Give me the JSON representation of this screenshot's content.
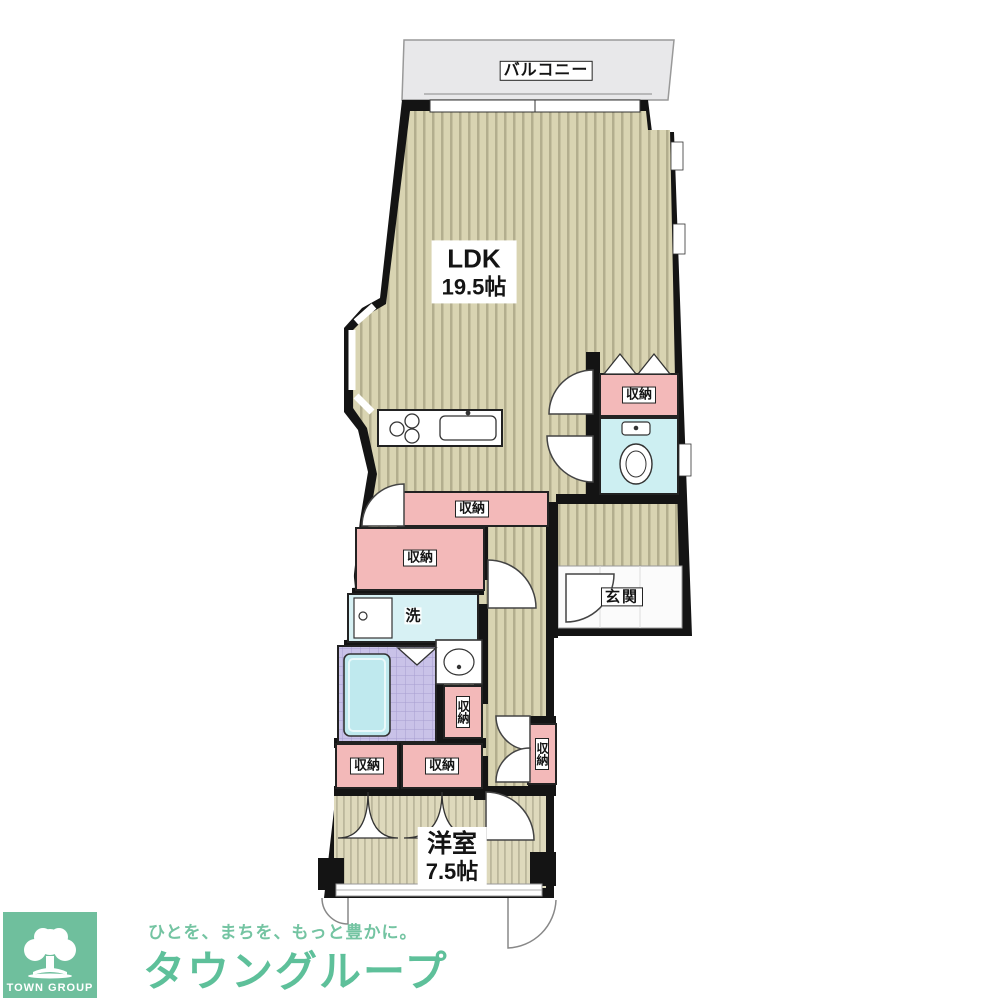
{
  "floorplan": {
    "balcony": "バルコニー",
    "ldk_name": "LDK",
    "ldk_size": "19.5帖",
    "western_room_name": "洋室",
    "western_room_size": "7.5帖",
    "entrance": "玄関",
    "wash": "洗",
    "storages": [
      "収納",
      "収納",
      "収納",
      "収納",
      "収納",
      "収納",
      "収納"
    ],
    "colors": {
      "flooring": "#d9d4b2",
      "flooring_stripe": "#b3ae8e",
      "storage_pink": "#f3b9b9",
      "wet_area_blue": "#d7f1f4",
      "toilet_blue": "#cdeff2",
      "bath_tile_purple": "#c9c2e8",
      "bathtub_blue": "#bfe9ee",
      "balcony_gray": "#e8e8ea",
      "wall_black": "#141414"
    }
  },
  "branding": {
    "logo_text": "TOWN GROUP",
    "tagline": "ひとを、まちを、もっと豊かに。",
    "brand_name": "タウングループ",
    "brand_green": "#5ec09a"
  }
}
